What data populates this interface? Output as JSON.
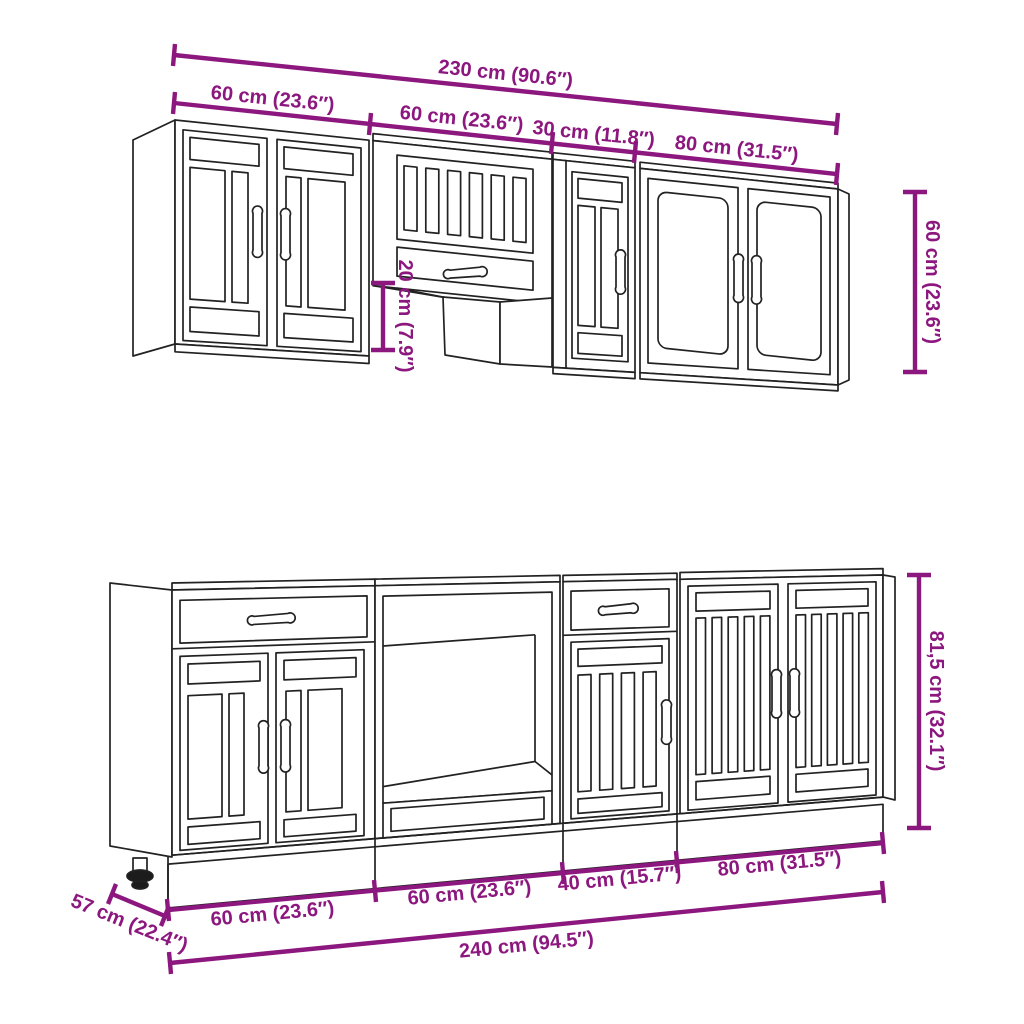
{
  "title": "Kitchen cabinet set dimension diagram",
  "colors": {
    "dimension": "#8C177E",
    "drawing": "#222222",
    "background": "#ffffff"
  },
  "upper_row": {
    "total_width_label": "230 cm (90.6″)",
    "segment_labels": [
      "60 cm (23.6″)",
      "60 cm (23.6″)",
      "30 cm (11.8″)",
      "80 cm (31.5″)"
    ],
    "cabinet_height_label": "60 cm (23.6″)",
    "open_section_height_label": "20 cm (7.9″)"
  },
  "lower_row": {
    "total_width_label": "240 cm (94.5″)",
    "segment_labels": [
      "60 cm (23.6″)",
      "60 cm (23.6″)",
      "40 cm (15.7″)",
      "80 cm (31.5″)"
    ],
    "cabinet_height_label": "81,5 cm (32.1″)",
    "depth_label": "57 cm (22.4″)"
  }
}
